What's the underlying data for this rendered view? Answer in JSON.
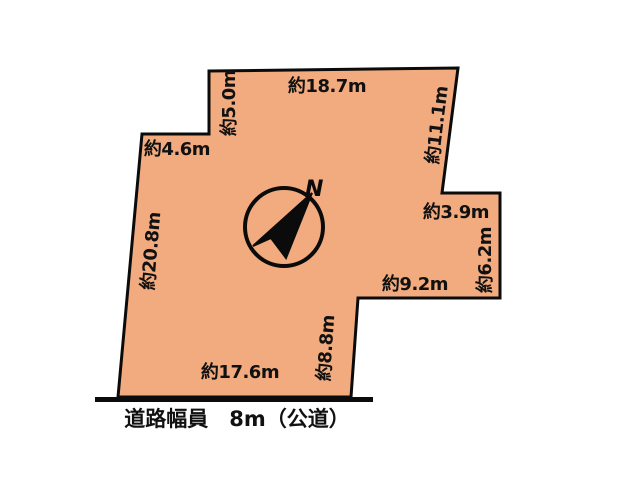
{
  "plot_diagram": {
    "dimensions": {
      "top": "約18.7m",
      "top_left_side": "約5.0m",
      "upper_left_step": "約4.6m",
      "left_side": "約20.8m",
      "right_upper_side": "約11.1m",
      "right_step_top": "約3.9m",
      "right_step_side": "約6.2m",
      "lower_step_top": "約9.2m",
      "lower_inner_side": "約8.8m",
      "bottom": "約17.6m"
    },
    "compass": {
      "north_label": "N"
    },
    "road": {
      "label": "道路幅員　8m（公道）"
    },
    "colors": {
      "land_fill": "#F2AB7F",
      "outline": "#000000",
      "background": "#FFFFFF"
    }
  }
}
